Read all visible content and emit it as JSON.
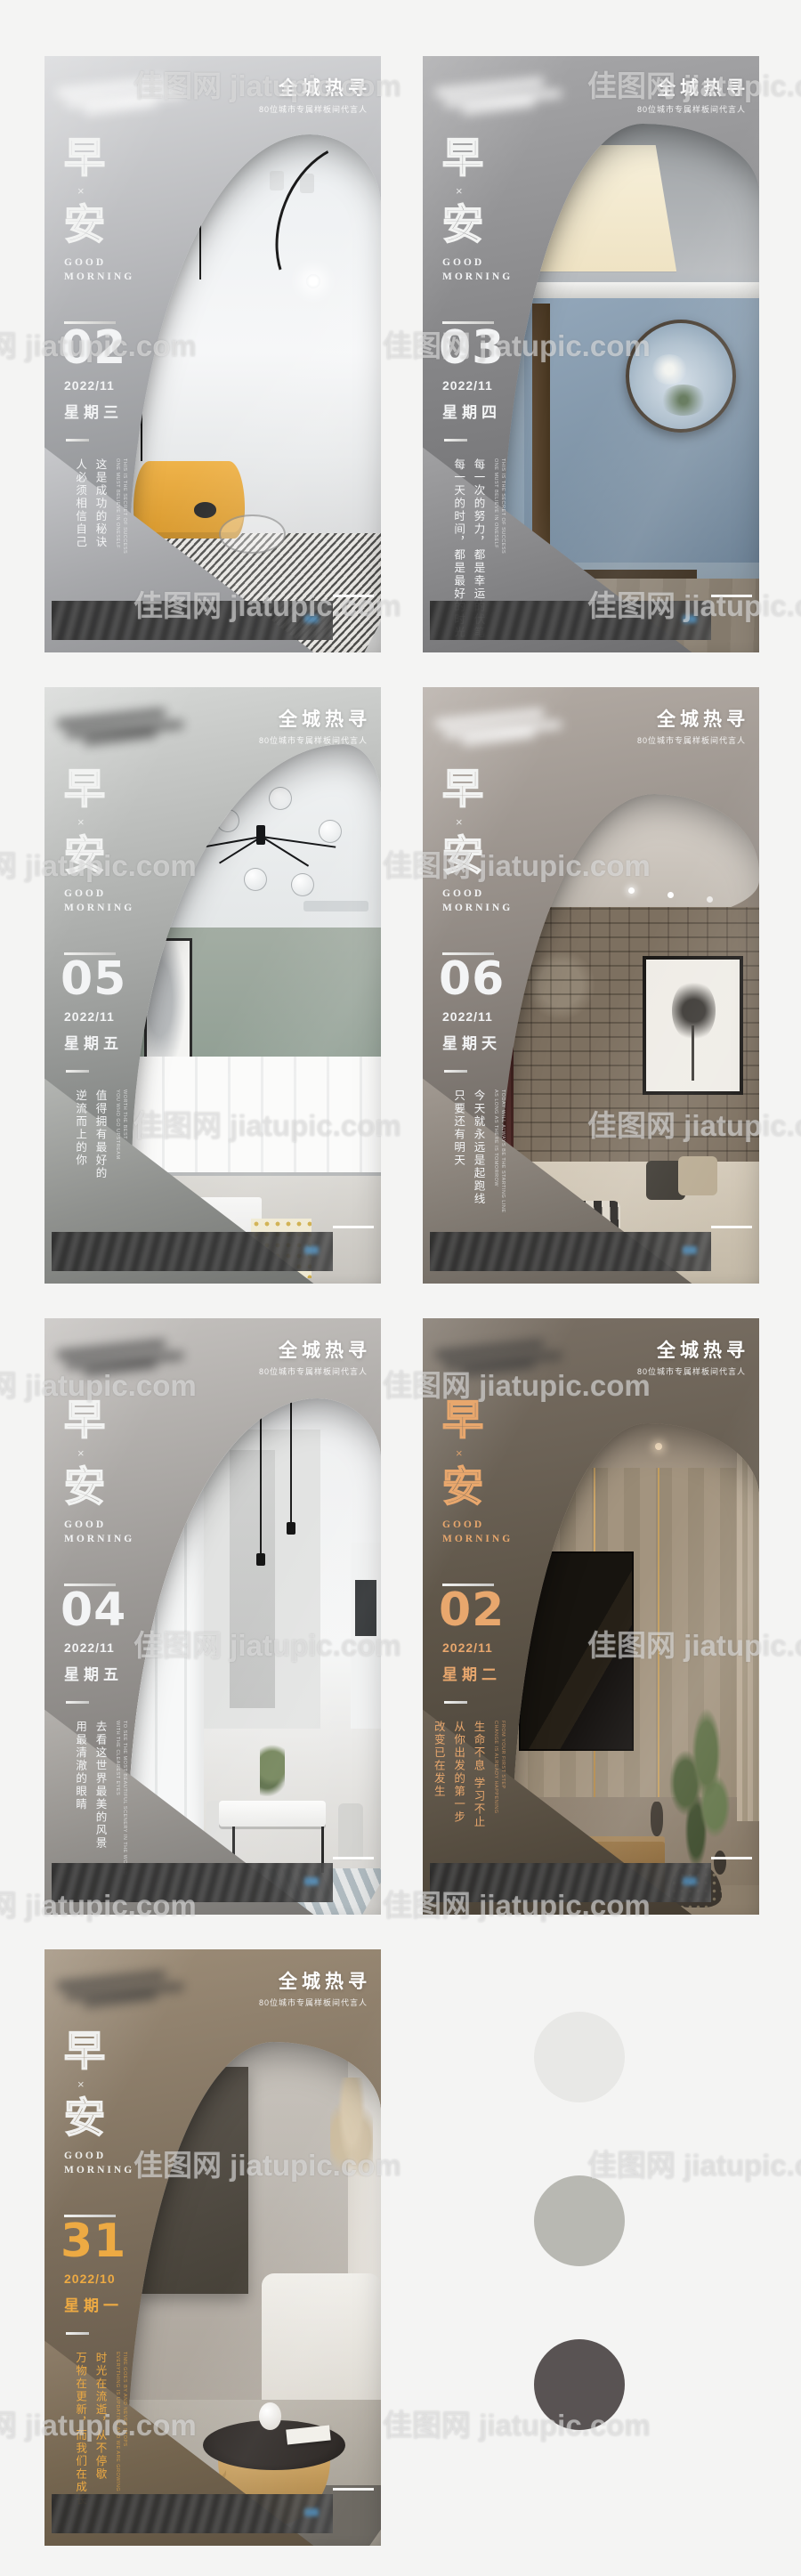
{
  "page": {
    "background": "#f4f4f3"
  },
  "watermark": {
    "text": "佳图网 jiatupic.com"
  },
  "shared": {
    "campaign_title": "全城热寻",
    "campaign_subtitle": "80位城市专属样板间代言人",
    "zao": "早",
    "multiply": "×",
    "an": "安",
    "good": "GOOD",
    "morning": "MORNING"
  },
  "posters": [
    {
      "day": "02",
      "date": "2022/11",
      "weekday": "星期三",
      "accent": "#f3f4f5",
      "lines": [
        "这是成功的秘诀",
        "人必须相信自己"
      ],
      "english": [
        "THIS IS THE SECRET OF SUCCESS",
        "ONE MUST BELIEVE IN ONESELF"
      ]
    },
    {
      "day": "03",
      "date": "2022/11",
      "weekday": "星期四",
      "accent": "#f3f4f5",
      "lines": [
        "每一次的努力，都是幸运的伏笔",
        "每一天的时间，都是最好的时光"
      ],
      "english": [
        "THIS IS THE SECRET OF SUCCESS",
        "ONE MUST BELIEVE IN ONESELF"
      ]
    },
    {
      "day": "05",
      "date": "2022/11",
      "weekday": "星期五",
      "accent": "#f3f4f5",
      "lines": [
        "值得拥有最好的",
        "逆流而上的你"
      ],
      "english": [
        "WORTH THE BEST",
        "YOU WHO GO UPSTREAM"
      ]
    },
    {
      "day": "06",
      "date": "2022/11",
      "weekday": "星期天",
      "accent": "#f3f4f5",
      "lines": [
        "今天就永远是起跑线",
        "只要还有明天"
      ],
      "english": [
        "TODAY WILL ALWAYS BE THE STARTING LINE",
        "AS LONG AS THERE IS TOMORROW"
      ]
    },
    {
      "day": "04",
      "date": "2022/11",
      "weekday": "星期五",
      "accent": "#f3f4f5",
      "lines": [
        "去看这世界最美的风景",
        "用最清澈的眼睛"
      ],
      "english": [
        "TO SEE THE MOST BEAUTIFUL SCENERY IN THE WORLD",
        "WITH THE CLEAREST EYES"
      ]
    },
    {
      "day": "02",
      "date": "2022/11",
      "weekday": "星期二",
      "accent": "#e8a76d",
      "lines": [
        "生命不息 学习不止",
        "从你出发的第一步",
        "改变已在发生"
      ],
      "english": [
        "FROM YOUR FIRST STEP",
        "CHANGE IS ALREADY HAPPENING"
      ]
    },
    {
      "day": "31",
      "date": "2022/10",
      "weekday": "星期一",
      "accent": "#edaa43",
      "lines": [
        "时光在流逝，从不停歇",
        "万物在更新，而我们在成长"
      ],
      "english": [
        "TIME GOES BY AND NEVER STOPS",
        "EVERYTHING IS UPDATING AND WE ARE GROWING"
      ]
    }
  ],
  "palette": [
    {
      "color": "#e8e8e6",
      "css": "background:#e8e8e6"
    },
    {
      "color": "#b8b8b2",
      "css": "background:#b8b8b2"
    },
    {
      "color": "#595353",
      "css": "background:#595353"
    }
  ]
}
